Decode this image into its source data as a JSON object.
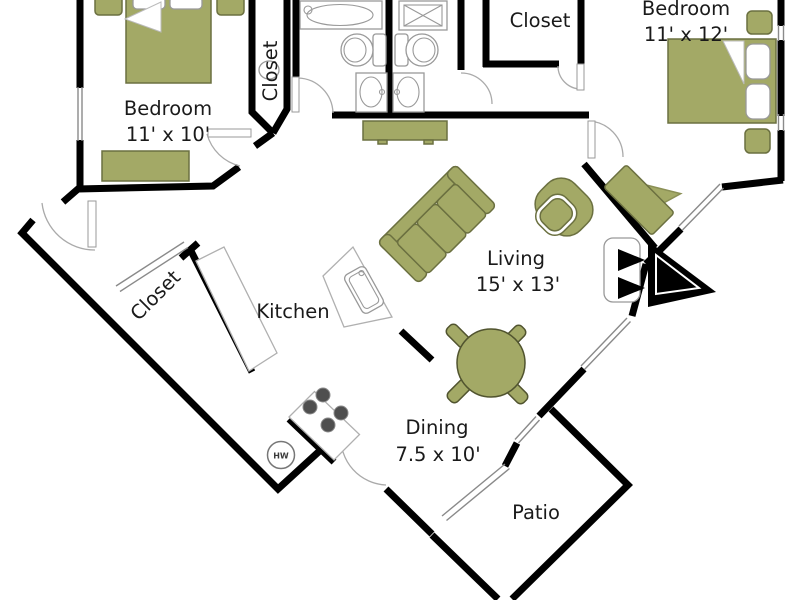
{
  "rooms": {
    "bedroom1": {
      "name": "Bedroom",
      "dims": "11' x 10'"
    },
    "bedroom2": {
      "name": "Bedroom",
      "dims": "11' x 12'"
    },
    "living": {
      "name": "Living",
      "dims": "15' x 13'"
    },
    "dining": {
      "name": "Dining",
      "dims": "7.5 x 10'"
    },
    "kitchen": {
      "name": "Kitchen"
    },
    "patio": {
      "name": "Patio"
    },
    "closet_hall": {
      "name": "Closet"
    },
    "closet_top": {
      "name": "Closet"
    },
    "closet_entry": {
      "name": "Closet"
    }
  },
  "fixtures": {
    "water_heater": "HW"
  },
  "colors": {
    "wall": "#000000",
    "furniture": "#a3a966",
    "furniture_border": "#6b7040",
    "fixture_outline": "#999999",
    "label_text": "#1a1a1a"
  }
}
